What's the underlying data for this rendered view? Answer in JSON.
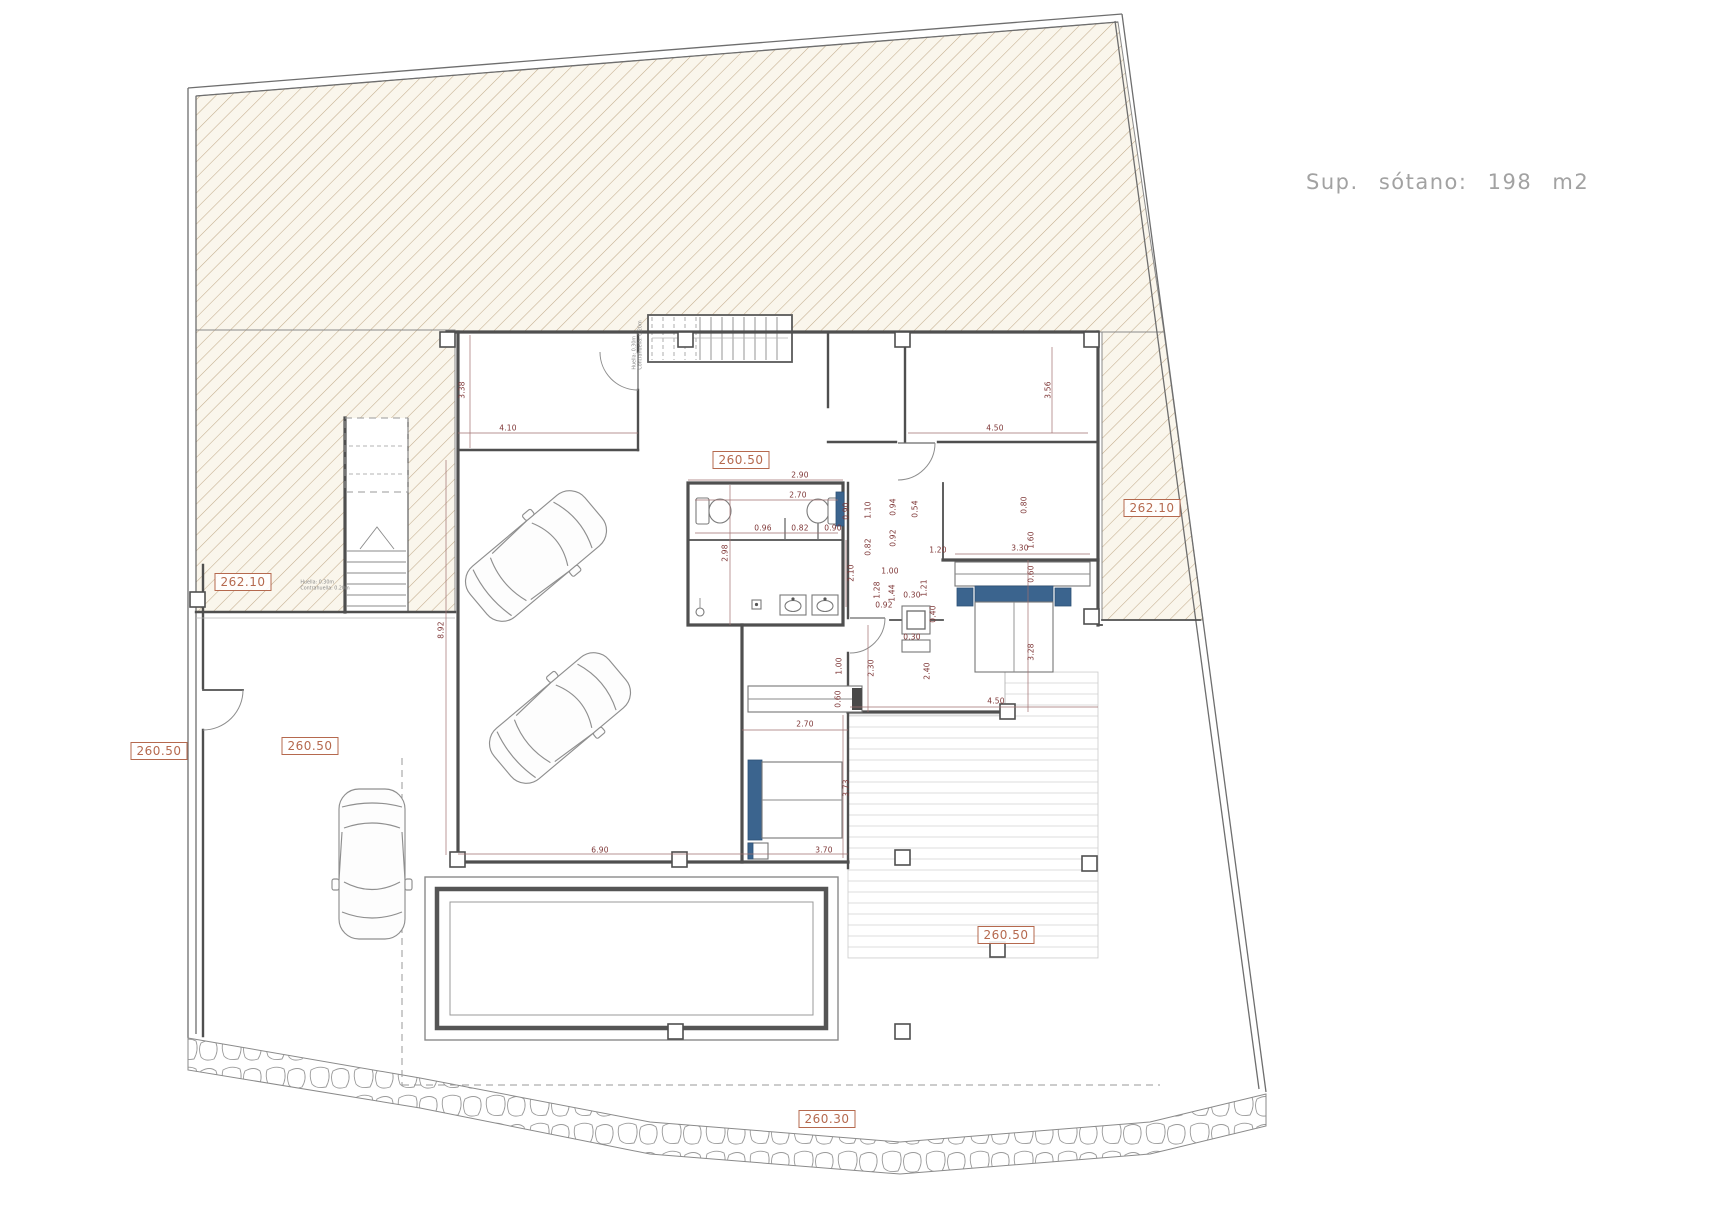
{
  "title": {
    "text": "Sup. sótano: 198 m2"
  },
  "colors": {
    "wall": "#4f4f4f",
    "hatch_line": "#c3ad8d",
    "hatch_bg": "#faf6ec",
    "dimension_text": "#7d3535",
    "dimension_line": "#a07070",
    "elevation_label": "#b5694e",
    "furniture_blue": "#3b648e",
    "title_text": "#a2a2a2",
    "deck_line": "#dcdcdc",
    "stone_line": "#9a9a9a"
  },
  "elevation_markers": [
    {
      "label": "262.10",
      "x": 243,
      "y": 582
    },
    {
      "label": "262.10",
      "x": 1152,
      "y": 508
    },
    {
      "label": "260.50",
      "x": 159,
      "y": 751
    },
    {
      "label": "260.50",
      "x": 310,
      "y": 746
    },
    {
      "label": "260.50",
      "x": 741,
      "y": 460
    },
    {
      "label": "260.50",
      "x": 1006,
      "y": 935
    },
    {
      "label": "260.30",
      "x": 827,
      "y": 1119
    }
  ],
  "dimensions": [
    {
      "v": "3.38",
      "x": 462,
      "y": 390,
      "r": -90
    },
    {
      "v": "4.10",
      "x": 508,
      "y": 428,
      "r": 0
    },
    {
      "v": "4.50",
      "x": 995,
      "y": 428,
      "r": 0
    },
    {
      "v": "3.56",
      "x": 1048,
      "y": 390,
      "r": -90
    },
    {
      "v": "2.90",
      "x": 800,
      "y": 475,
      "r": 0
    },
    {
      "v": "2.70",
      "x": 798,
      "y": 495,
      "r": 0
    },
    {
      "v": "0.90",
      "x": 846,
      "y": 511,
      "r": -90
    },
    {
      "v": "0.96",
      "x": 763,
      "y": 528,
      "r": 0
    },
    {
      "v": "0.82",
      "x": 800,
      "y": 528,
      "r": 0
    },
    {
      "v": "0.90",
      "x": 833,
      "y": 528,
      "r": 0
    },
    {
      "v": "2.98",
      "x": 725,
      "y": 553,
      "r": -90
    },
    {
      "v": "2.10",
      "x": 851,
      "y": 573,
      "r": -90
    },
    {
      "v": "0.94",
      "x": 893,
      "y": 507,
      "r": -90
    },
    {
      "v": "1.10",
      "x": 868,
      "y": 510,
      "r": -90
    },
    {
      "v": "0.54",
      "x": 915,
      "y": 509,
      "r": -90
    },
    {
      "v": "0.92",
      "x": 893,
      "y": 538,
      "r": -90
    },
    {
      "v": "0.82",
      "x": 868,
      "y": 547,
      "r": -90
    },
    {
      "v": "1.20",
      "x": 938,
      "y": 550,
      "r": 0
    },
    {
      "v": "3.30",
      "x": 1020,
      "y": 548,
      "r": 0
    },
    {
      "v": "1.60",
      "x": 1031,
      "y": 540,
      "r": -90
    },
    {
      "v": "0.80",
      "x": 1024,
      "y": 505,
      "r": -90
    },
    {
      "v": "0.60",
      "x": 1031,
      "y": 574,
      "r": -90
    },
    {
      "v": "1.00",
      "x": 890,
      "y": 571,
      "r": 0
    },
    {
      "v": "1.28",
      "x": 877,
      "y": 590,
      "r": -90
    },
    {
      "v": "1.44",
      "x": 892,
      "y": 593,
      "r": -90
    },
    {
      "v": "1.21",
      "x": 924,
      "y": 588,
      "r": -90
    },
    {
      "v": "0.30",
      "x": 912,
      "y": 595,
      "r": 0
    },
    {
      "v": "0.92",
      "x": 884,
      "y": 605,
      "r": 0
    },
    {
      "v": "0.40",
      "x": 933,
      "y": 614,
      "r": -90
    },
    {
      "v": "0.30",
      "x": 912,
      "y": 637,
      "r": 0
    },
    {
      "v": "3.28",
      "x": 1031,
      "y": 652,
      "r": -90
    },
    {
      "v": "1.00",
      "x": 839,
      "y": 666,
      "r": -90
    },
    {
      "v": "2.30",
      "x": 871,
      "y": 668,
      "r": -90
    },
    {
      "v": "2.40",
      "x": 927,
      "y": 671,
      "r": -90
    },
    {
      "v": "0.60",
      "x": 838,
      "y": 699,
      "r": -90
    },
    {
      "v": "4.50",
      "x": 996,
      "y": 701,
      "r": 0
    },
    {
      "v": "2.70",
      "x": 805,
      "y": 724,
      "r": 0
    },
    {
      "v": "3.73",
      "x": 846,
      "y": 788,
      "r": -90
    },
    {
      "v": "8.92",
      "x": 441,
      "y": 630,
      "r": -90
    },
    {
      "v": "6.90",
      "x": 600,
      "y": 850,
      "r": 0
    },
    {
      "v": "3.70",
      "x": 824,
      "y": 850,
      "r": 0
    }
  ],
  "notes": [
    {
      "lines": [
        "Huella: 0.30m",
        "Contrahuella: 0.20m"
      ],
      "x": 638,
      "y": 345,
      "r": -90
    },
    {
      "lines": [
        "Huella: 0.30m",
        "Contrahuella: 0.20m"
      ],
      "x": 325,
      "y": 586,
      "r": 0
    }
  ]
}
